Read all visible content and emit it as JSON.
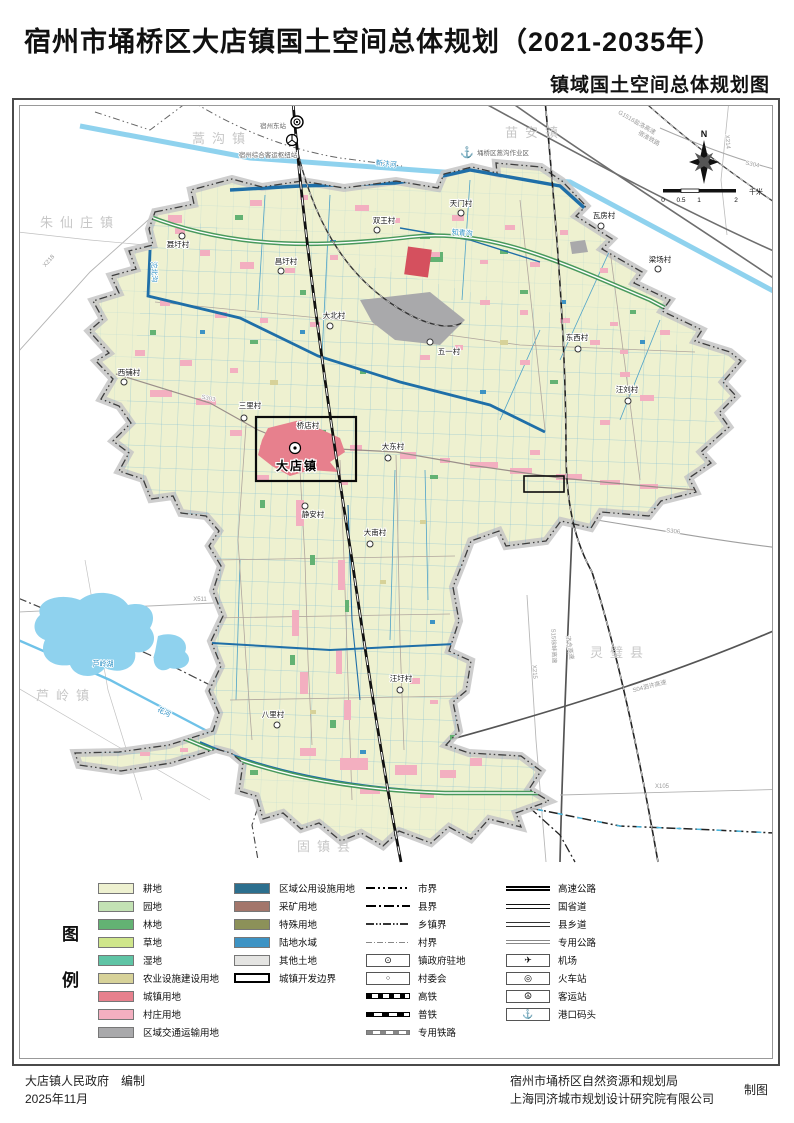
{
  "title": "宿州市埇桥区大店镇国土空间总体规划（2021-2035年）",
  "subtitle": "镇域国土空间总体规划图",
  "legend": {
    "heading": {
      "top": "图",
      "bottom": "例"
    },
    "col1": [
      {
        "label": "耕地",
        "color": "#EEF1D0"
      },
      {
        "label": "园地",
        "color": "#C3E2B4"
      },
      {
        "label": "林地",
        "color": "#63B273"
      },
      {
        "label": "草地",
        "color": "#CFE68B"
      },
      {
        "label": "湿地",
        "color": "#5FC4A5"
      },
      {
        "label": "农业设施建设用地",
        "color": "#D7D299"
      },
      {
        "label": "城镇用地",
        "color": "#E7808D"
      },
      {
        "label": "村庄用地",
        "color": "#F3AFC0"
      },
      {
        "label": "区域交通运输用地",
        "color": "#A9A9AB"
      }
    ],
    "col2": [
      {
        "label": "区域公用设施用地",
        "color": "#2C6F8E"
      },
      {
        "label": "采矿用地",
        "color": "#A3766B"
      },
      {
        "label": "特殊用地",
        "color": "#8C9159"
      },
      {
        "label": "陆地水域",
        "color": "#3D93C4"
      },
      {
        "label": "其他土地",
        "color": "#E4E4E2"
      },
      {
        "label": "城镇开发边界",
        "color": "#FFFFFF"
      }
    ],
    "col3": [
      "市界",
      "县界",
      "乡镇界",
      "村界",
      "镇政府驻地",
      "村委会",
      "高铁",
      "普铁",
      "专用铁路"
    ],
    "col4": [
      "高速公路",
      "国省道",
      "县乡道",
      "专用公路",
      "机场",
      "火车站",
      "客运站",
      "港口码头"
    ],
    "col4_glyphs": {
      "airport": "✈",
      "train_station": "◎",
      "bus_station": "☮",
      "port": "⚓"
    },
    "marker_glyphs": {
      "town_gov": "⊙",
      "village_committee": "○"
    }
  },
  "map": {
    "town_label": "大店镇",
    "neighbors": [
      "蒿沟镇",
      "苗安镇",
      "朱仙庄镇",
      "芦岭镇",
      "灵璧县",
      "固镇县"
    ],
    "villages": [
      "聂圩村",
      "昌圩村",
      "双王村",
      "天门村",
      "瓦房村",
      "梁场村",
      "大北村",
      "五一村",
      "西铺村",
      "三里村",
      "桥店村",
      "大东村",
      "东西村",
      "汪刘村",
      "静安村",
      "大南村",
      "汪圩村",
      "八里村"
    ],
    "rivers": [
      "新汴河",
      "知青沟",
      "沱北沟",
      "花河",
      "芦岭湖"
    ],
    "roads": [
      "X218",
      "X511",
      "X215",
      "X214",
      "X105",
      "S303",
      "S304",
      "S306",
      "G1516盐洛高速",
      "宿淮铁路",
      "S15徐蚌高速",
      "济合高速",
      "S04泗许高速"
    ],
    "stations": [
      "宿州东站",
      "宿州综合客运枢纽站",
      "埇桥区蒿沟作业区"
    ],
    "compass": "N",
    "scale": {
      "ticks": [
        "0",
        "0.5",
        "1",
        "2"
      ],
      "unit": "千米"
    }
  },
  "footer": {
    "left_line1": "大店镇人民政府　编制",
    "left_line2": "2025年11月",
    "right_line1": "宿州市埇桥区自然资源和规划局",
    "right_line2": "上海同济城市规划设计研究院有限公司",
    "right_note": "制图"
  }
}
